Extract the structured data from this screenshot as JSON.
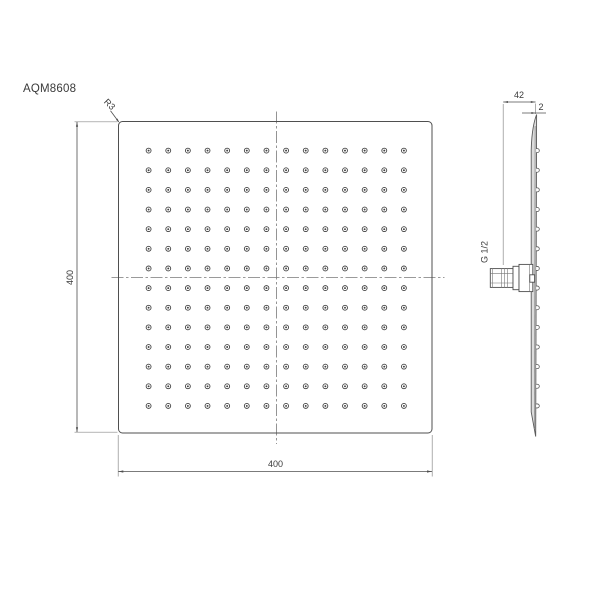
{
  "model": "AQM8608",
  "drawing": {
    "front_view": {
      "width_dim": "400",
      "height_dim": "400",
      "corner_radius": "R3",
      "nozzle_rows": 14,
      "nozzle_cols": 14
    },
    "side_view": {
      "depth_dim": "42",
      "face_thickness_dim": "2",
      "thread_size": "G 1/2"
    },
    "colors": {
      "line": "#4f4f4f",
      "extension_line": "#8a8a8a",
      "text": "#3a3a3a",
      "panel_fill": "#dcdcdc",
      "background": "#ffffff"
    }
  }
}
